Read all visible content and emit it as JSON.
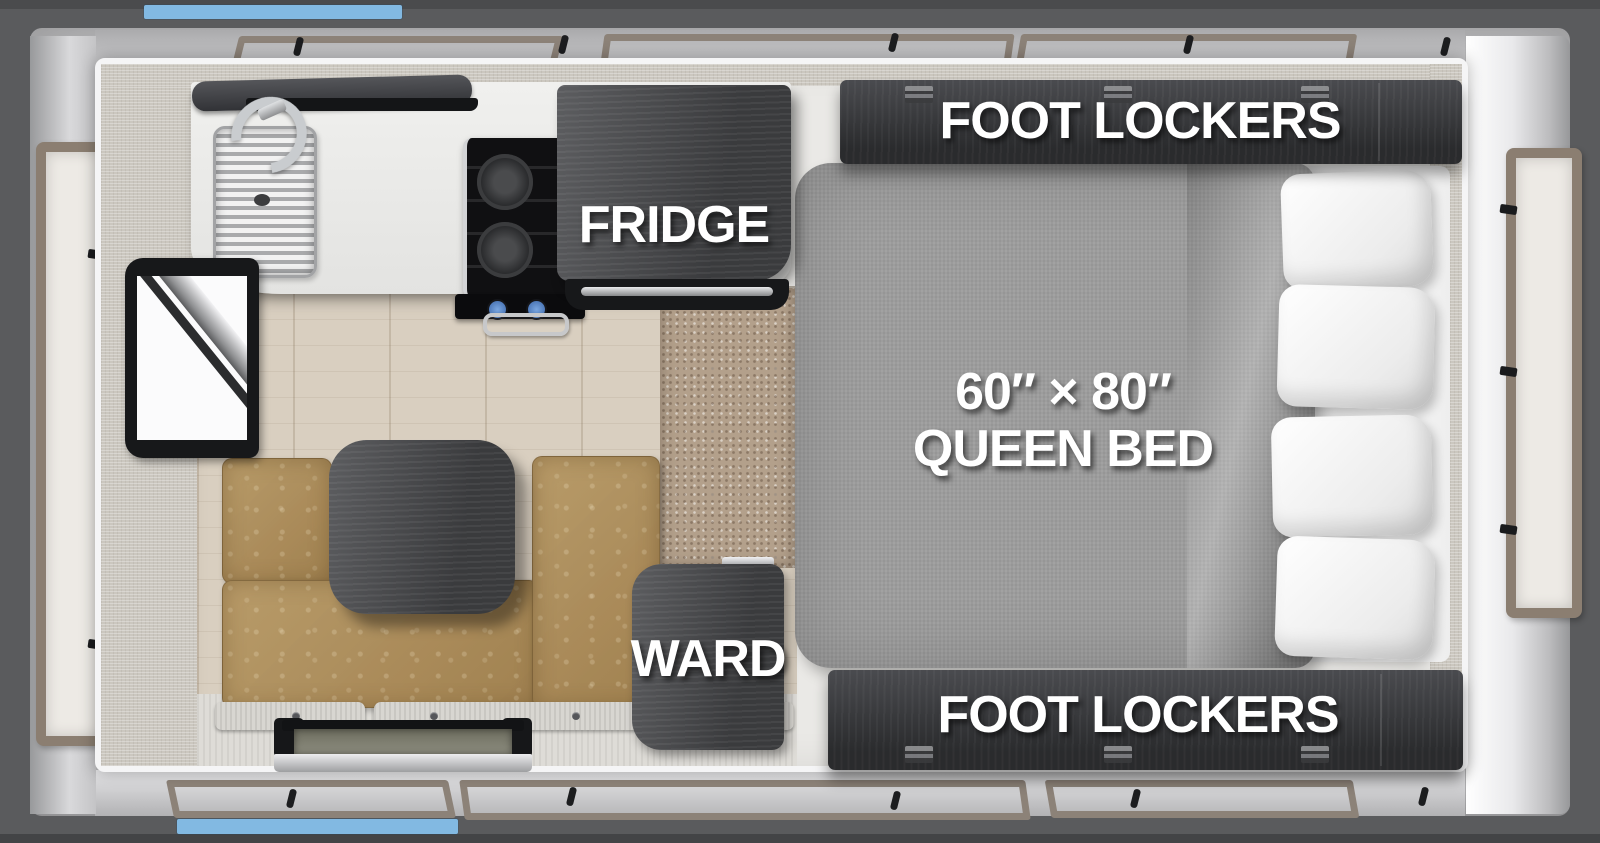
{
  "diagram": {
    "type": "rv-truck-camper-floorplan-top-view",
    "labels": {
      "foot_lockers_top": "FOOT LOCKERS",
      "foot_lockers_bottom": "FOOT LOCKERS",
      "fridge": "FRIDGE",
      "ward": "WARD",
      "bed_size": "60″ × 80″",
      "bed_name": "QUEEN BED"
    },
    "palette": {
      "accent_blue": "#82B9E2",
      "shell_gray": "#5A5B5D",
      "wall_gray": "#C9C9CB",
      "trim_white": "#F5F5F6",
      "cabinet_dark_wood": "#323336",
      "seat_leather_tan": "#AD8D59",
      "bed_fabric_gray": "#9D9D9D",
      "pillow_white": "#F6F6F6",
      "floor_wood": "#D9CFC0",
      "carpet_brown": "#B3A08B",
      "window_frame_taupe": "#8B7E71",
      "label_text": "#FFFFFF"
    }
  }
}
